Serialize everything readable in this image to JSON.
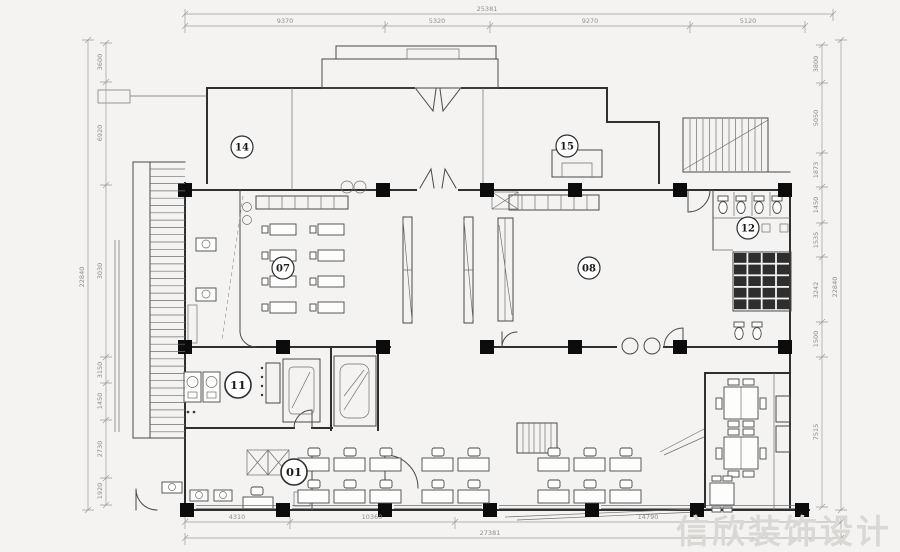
{
  "watermark": "信欣装饰设计",
  "colors": {
    "paper": "#f4f3f1",
    "line": "#4a4a4a",
    "wall": "#2f2f2f",
    "column": "#0c0c0c",
    "dimension_text": "#8f8f8f",
    "watermark": "#d9d8d5"
  },
  "rooms": [
    {
      "label": "14",
      "x": 242,
      "y": 147
    },
    {
      "label": "15",
      "x": 567,
      "y": 146
    },
    {
      "label": "07",
      "x": 283,
      "y": 268
    },
    {
      "label": "08",
      "x": 589,
      "y": 268
    },
    {
      "label": "12",
      "x": 748,
      "y": 228
    },
    {
      "label": "11",
      "x": 238,
      "y": 385,
      "big": true
    },
    {
      "label": "01",
      "x": 294,
      "y": 472,
      "big": true
    }
  ],
  "dim_labels": [
    {
      "text": "25381",
      "x": 487,
      "y": 11
    },
    {
      "text": "9370",
      "x": 285,
      "y": 23
    },
    {
      "text": "5320",
      "x": 437,
      "y": 23
    },
    {
      "text": "9270",
      "x": 590,
      "y": 23
    },
    {
      "text": "5120",
      "x": 748,
      "y": 23
    },
    {
      "text": "4310",
      "x": 237,
      "y": 519
    },
    {
      "text": "10360",
      "x": 372,
      "y": 519
    },
    {
      "text": "14790",
      "x": 648,
      "y": 519
    },
    {
      "text": "27381",
      "x": 490,
      "y": 535
    },
    {
      "text": "22840",
      "x": 84,
      "y": 277,
      "rot": -90
    },
    {
      "text": "3600",
      "x": 102,
      "y": 62,
      "rot": -90
    },
    {
      "text": "6920",
      "x": 102,
      "y": 133,
      "rot": -90
    },
    {
      "text": "3030",
      "x": 102,
      "y": 271,
      "rot": -90
    },
    {
      "text": "3150",
      "x": 102,
      "y": 370,
      "rot": -90
    },
    {
      "text": "1450",
      "x": 102,
      "y": 401,
      "rot": -90
    },
    {
      "text": "2730",
      "x": 102,
      "y": 449,
      "rot": -90
    },
    {
      "text": "1920",
      "x": 102,
      "y": 491,
      "rot": -90
    },
    {
      "text": "3800",
      "x": 818,
      "y": 64,
      "rot": -90
    },
    {
      "text": "5050",
      "x": 818,
      "y": 118,
      "rot": -90
    },
    {
      "text": "1873",
      "x": 818,
      "y": 170,
      "rot": -90
    },
    {
      "text": "1450",
      "x": 818,
      "y": 205,
      "rot": -90
    },
    {
      "text": "1535",
      "x": 818,
      "y": 240,
      "rot": -90
    },
    {
      "text": "3242",
      "x": 818,
      "y": 290,
      "rot": -90
    },
    {
      "text": "1500",
      "x": 818,
      "y": 339,
      "rot": -90
    },
    {
      "text": "7515",
      "x": 818,
      "y": 432,
      "rot": -90
    },
    {
      "text": "22840",
      "x": 837,
      "y": 287,
      "rot": -90
    }
  ]
}
